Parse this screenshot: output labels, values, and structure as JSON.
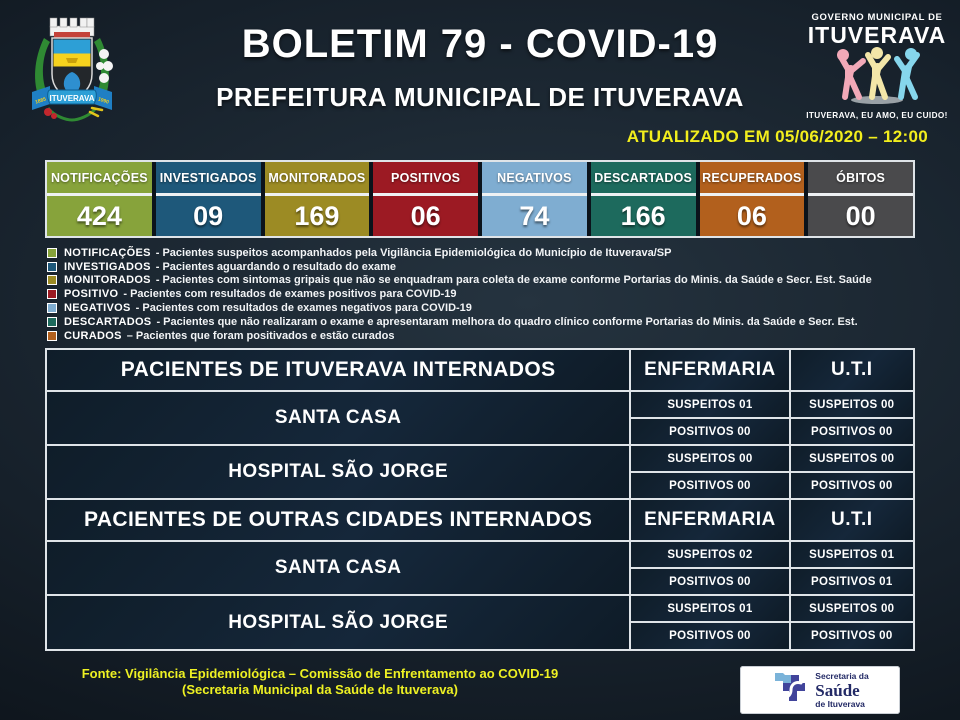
{
  "header": {
    "title": "BOLETIM 79 - COVID-19",
    "subtitle": "PREFEITURA MUNICIPAL DE ITUVERAVA",
    "updated": "ATUALIZADO EM 05/06/2020 – 12:00",
    "crest": {
      "banner": "ITUVERAVA",
      "year_left": "1885",
      "year_right": "1990"
    },
    "gov_logo": {
      "line1": "GOVERNO MUNICIPAL DE",
      "line2": "ITUVERAVA",
      "slogan": "ITUVERAVA, EU AMO, EU CUIDO!",
      "figure_colors": [
        "#f2a9b8",
        "#f3e6a8",
        "#86d6ec"
      ]
    }
  },
  "stats": [
    {
      "label": "NOTIFICAÇÕES",
      "value": "424",
      "color": "#87a33b"
    },
    {
      "label": "INVESTIGADOS",
      "value": "09",
      "color": "#1e587a"
    },
    {
      "label": "MONITORADOS",
      "value": "169",
      "color": "#9c8b24"
    },
    {
      "label": "POSITIVOS",
      "value": "06",
      "color": "#9c1a23"
    },
    {
      "label": "NEGATIVOS",
      "value": "74",
      "color": "#7fadd1"
    },
    {
      "label": "DESCARTADOS",
      "value": "166",
      "color": "#1d6a5d"
    },
    {
      "label": "RECUPERADOS",
      "value": "06",
      "color": "#b2601d"
    },
    {
      "label": "ÓBITOS",
      "value": "00",
      "color": "#4a4a4c"
    }
  ],
  "legend": [
    {
      "term": "NOTIFICAÇÕES",
      "desc": "- Pacientes suspeitos acompanhados pela Vigilância Epidemiológica do Município de Ituverava/SP",
      "color": "#87a33b"
    },
    {
      "term": "INVESTIGADOS",
      "desc": "- Pacientes aguardando o resultado do exame",
      "color": "#1e587a"
    },
    {
      "term": "MONITORADOS",
      "desc": "- Pacientes com sintomas gripais que não se enquadram para coleta de exame conforme Portarias do Minis. da Saúde e Secr. Est. Saúde",
      "color": "#9c8b24"
    },
    {
      "term": "POSITIVO",
      "desc": "- Pacientes com resultados de exames positivos para COVID-19",
      "color": "#9c1a23"
    },
    {
      "term": "NEGATIVOS",
      "desc": "- Pacientes com resultados de exames negativos para COVID-19",
      "color": "#7fadd1"
    },
    {
      "term": "DESCARTADOS",
      "desc": "- Pacientes que não realizaram o exame e apresentaram melhora do quadro clínico conforme Portarias do Minis. da Saúde e Secr. Est.",
      "color": "#1d6a5d"
    },
    {
      "term": "CURADOS",
      "desc": "– Pacientes que foram positivados e estão curados",
      "color": "#b2601d"
    }
  ],
  "internados": {
    "sections": [
      {
        "title": "PACIENTES DE ITUVERAVA INTERNADOS",
        "col_enfermaria": "ENFERMARIA",
        "col_uti": "U.T.I",
        "rows": [
          {
            "hospital": "SANTA CASA",
            "enfermaria_suspeitos": "SUSPEITOS 01",
            "enfermaria_positivos": "POSITIVOS 00",
            "uti_suspeitos": "SUSPEITOS 00",
            "uti_positivos": "POSITIVOS 00"
          },
          {
            "hospital": "HOSPITAL SÃO JORGE",
            "enfermaria_suspeitos": "SUSPEITOS 00",
            "enfermaria_positivos": "POSITIVOS 00",
            "uti_suspeitos": "SUSPEITOS 00",
            "uti_positivos": "POSITIVOS 00"
          }
        ]
      },
      {
        "title": "PACIENTES DE OUTRAS CIDADES INTERNADOS",
        "col_enfermaria": "ENFERMARIA",
        "col_uti": "U.T.I",
        "rows": [
          {
            "hospital": "SANTA CASA",
            "enfermaria_suspeitos": "SUSPEITOS 02",
            "enfermaria_positivos": "POSITIVOS 00",
            "uti_suspeitos": "SUSPEITOS 01",
            "uti_positivos": "POSITIVOS 01"
          },
          {
            "hospital": "HOSPITAL SÃO JORGE",
            "enfermaria_suspeitos": "SUSPEITOS 01",
            "enfermaria_positivos": "POSITIVOS 00",
            "uti_suspeitos": "SUSPEITOS 00",
            "uti_positivos": "POSITIVOS 00"
          }
        ]
      }
    ]
  },
  "footer": {
    "line1": "Fonte: Vigilância Epidemiológica – Comissão de Enfrentamento ao COVID-19",
    "line2": "(Secretaria Municipal da Saúde de Ituverava)",
    "saude_logo": {
      "line1": "Secretaria da",
      "line2": "Saúde",
      "line3": "de Ituverava"
    }
  }
}
